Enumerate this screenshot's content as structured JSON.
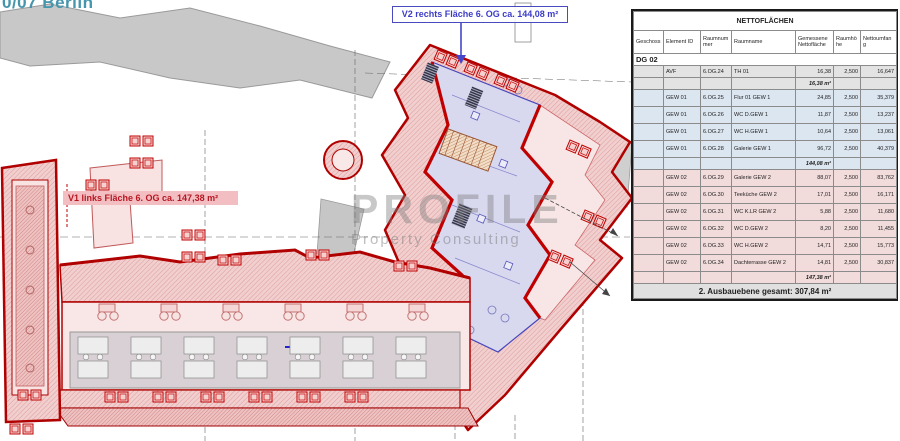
{
  "header": {
    "title": "0/07 Berlin"
  },
  "plan_labels": {
    "v2": "V2 rechts Fläche 6. OG ca. 144,08 m²",
    "v1": "V1 links Fläche 6. OG ca. 147,38 m²"
  },
  "watermark": {
    "line1": "PROFILE",
    "line2": "Property Consulting"
  },
  "table": {
    "title": "NETTOFLÄCHEN",
    "columns": [
      "Geschoss",
      "Element ID",
      "Raumnummer",
      "Raumname",
      "Gemessene Nettofläche",
      "Raumhöhe",
      "Nettoumfang"
    ],
    "section_label": "DG 02",
    "groups": [
      {
        "tint": "gray",
        "rows": [
          {
            "element_id": "AVF",
            "room_no": "6.OG.24",
            "room_name": "TH 01",
            "area": "16,38",
            "height": "2,500",
            "perimeter": "16,647"
          }
        ],
        "subtotal": "16,38 m²"
      },
      {
        "tint": "blue",
        "rows": [
          {
            "element_id": "GEW 01",
            "room_no": "6.OG.25",
            "room_name": "Flur 01 GEW 1",
            "area": "24,85",
            "height": "2,500",
            "perimeter": "35,379"
          },
          {
            "element_id": "GEW 01",
            "room_no": "6.OG.26",
            "room_name": "WC D.GEW 1",
            "area": "11,87",
            "height": "2,500",
            "perimeter": "13,237"
          },
          {
            "element_id": "GEW 01",
            "room_no": "6.OG.27",
            "room_name": "WC H.GEW 1",
            "area": "10,64",
            "height": "2,500",
            "perimeter": "13,061"
          },
          {
            "element_id": "GEW 01",
            "room_no": "6.OG.28",
            "room_name": "Galerie GEW 1",
            "area": "96,72",
            "height": "2,500",
            "perimeter": "40,379"
          }
        ],
        "subtotal": "144,08 m²"
      },
      {
        "tint": "pink",
        "rows": [
          {
            "element_id": "GEW 02",
            "room_no": "6.OG.29",
            "room_name": "Galerie GEW 2",
            "area": "88,07",
            "height": "2,500",
            "perimeter": "83,762"
          },
          {
            "element_id": "GEW 02",
            "room_no": "6.OG.30",
            "room_name": "Teeküche GEW 2",
            "area": "17,01",
            "height": "2,500",
            "perimeter": "16,171"
          },
          {
            "element_id": "GEW 02",
            "room_no": "6.OG.31",
            "room_name": "WC K.LR GEW 2",
            "area": "5,88",
            "height": "2,500",
            "perimeter": "11,680"
          },
          {
            "element_id": "GEW 02",
            "room_no": "6.OG.32",
            "room_name": "WC D.GEW 2",
            "area": "8,20",
            "height": "2,500",
            "perimeter": "11,455"
          },
          {
            "element_id": "GEW 02",
            "room_no": "6.OG.33",
            "room_name": "WC H.GEW 2",
            "area": "14,71",
            "height": "2,500",
            "perimeter": "15,773"
          },
          {
            "element_id": "GEW 02",
            "room_no": "6.OG.34",
            "room_name": "Dachterrasse GEW 2",
            "area": "14,81",
            "height": "2,500",
            "perimeter": "30,837"
          }
        ],
        "subtotal": "147,38 m²"
      }
    ],
    "footer": "2. Ausbauebene gesamt: 307,84 m²"
  },
  "colors": {
    "wall_red": "#b00000",
    "accent_blue": "#3c3cc8",
    "teal_heading": "#4595ad",
    "tint_blue_rows": "#dce6f1",
    "tint_pink_rows": "#f2dcdb",
    "tint_gray_rows": "#e3e3e3"
  }
}
